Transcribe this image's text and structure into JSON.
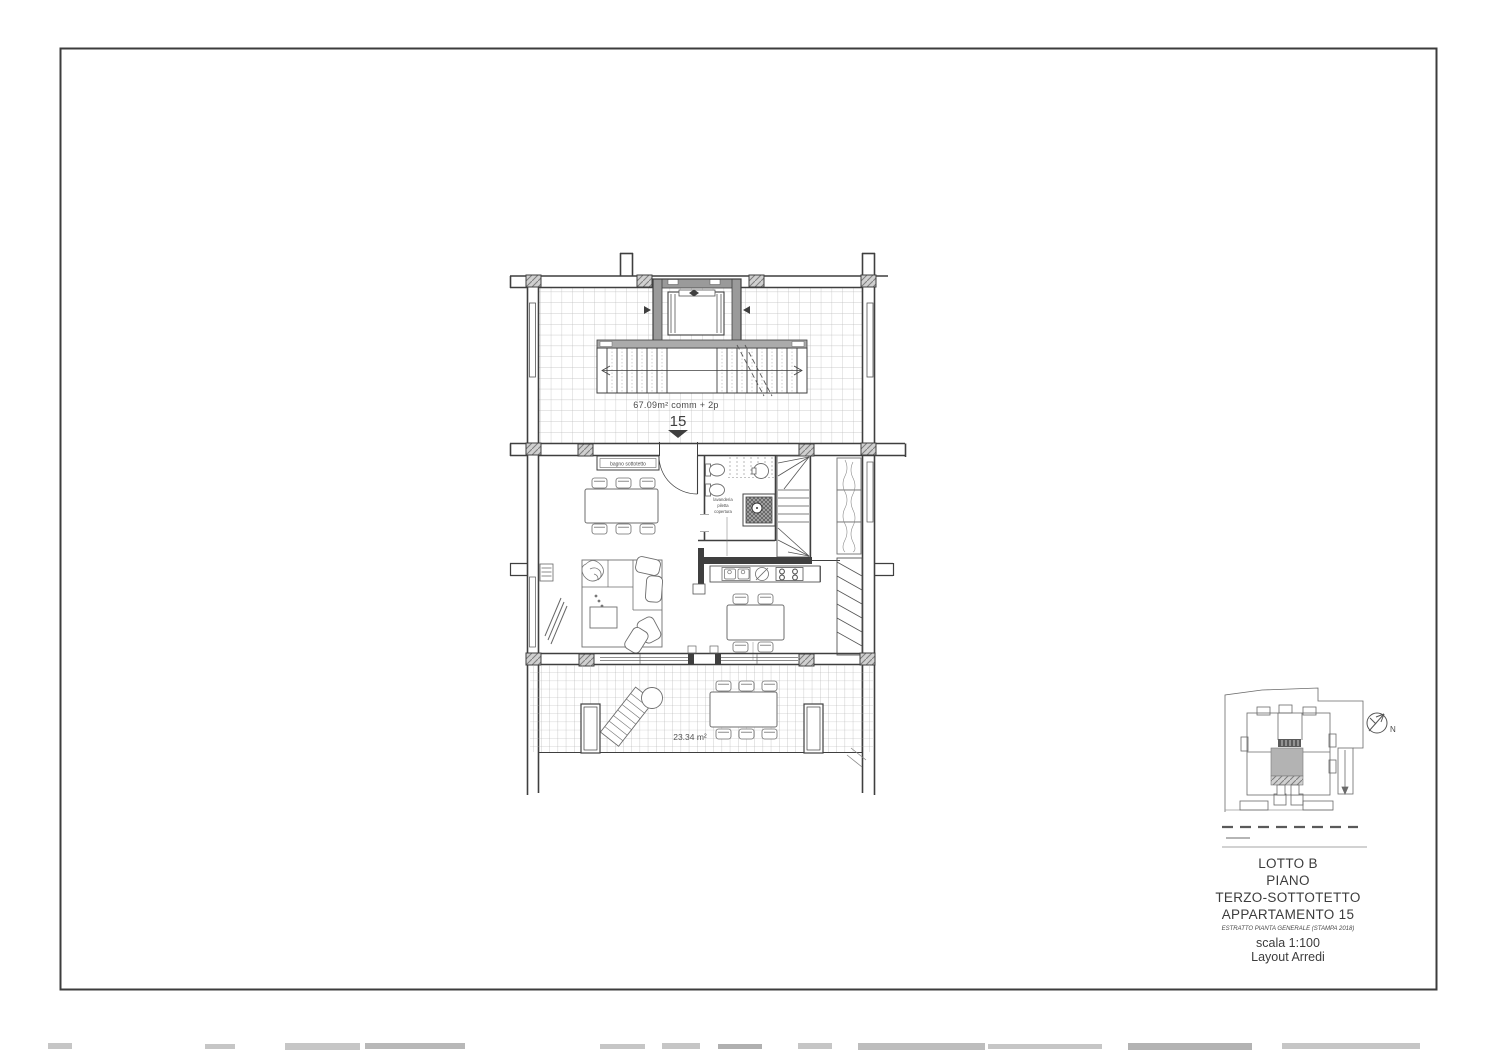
{
  "drawing": {
    "plan_labels": {
      "attic_area": "67.09m² comm + 2p",
      "unit_number": "15",
      "terrace_area": "23.34 m²",
      "bagno_box": "bagno sottotetto",
      "bath_note": [
        "lavanderia",
        "piletta",
        "copertura"
      ]
    },
    "key_plan": {
      "north": "N"
    },
    "title_block": {
      "lot": "LOTTO B",
      "floor_label": "PIANO",
      "floor_name": "TERZO-SOTTOTETTO",
      "apartment": "APPARTAMENTO 15",
      "note": "ESTRATTO PIANTA GENERALE (STAMPA 2018)",
      "scale": "scala 1:100",
      "layout": "Layout Arredi"
    },
    "colors": {
      "ink": "#3f3f3f",
      "grid_line": "#bcbcbc",
      "terrace_grid_line": "#adadad",
      "wall_fill": "#9a9a9a",
      "highlight_unit": "#b3b3b3",
      "paper": "#ffffff"
    }
  }
}
